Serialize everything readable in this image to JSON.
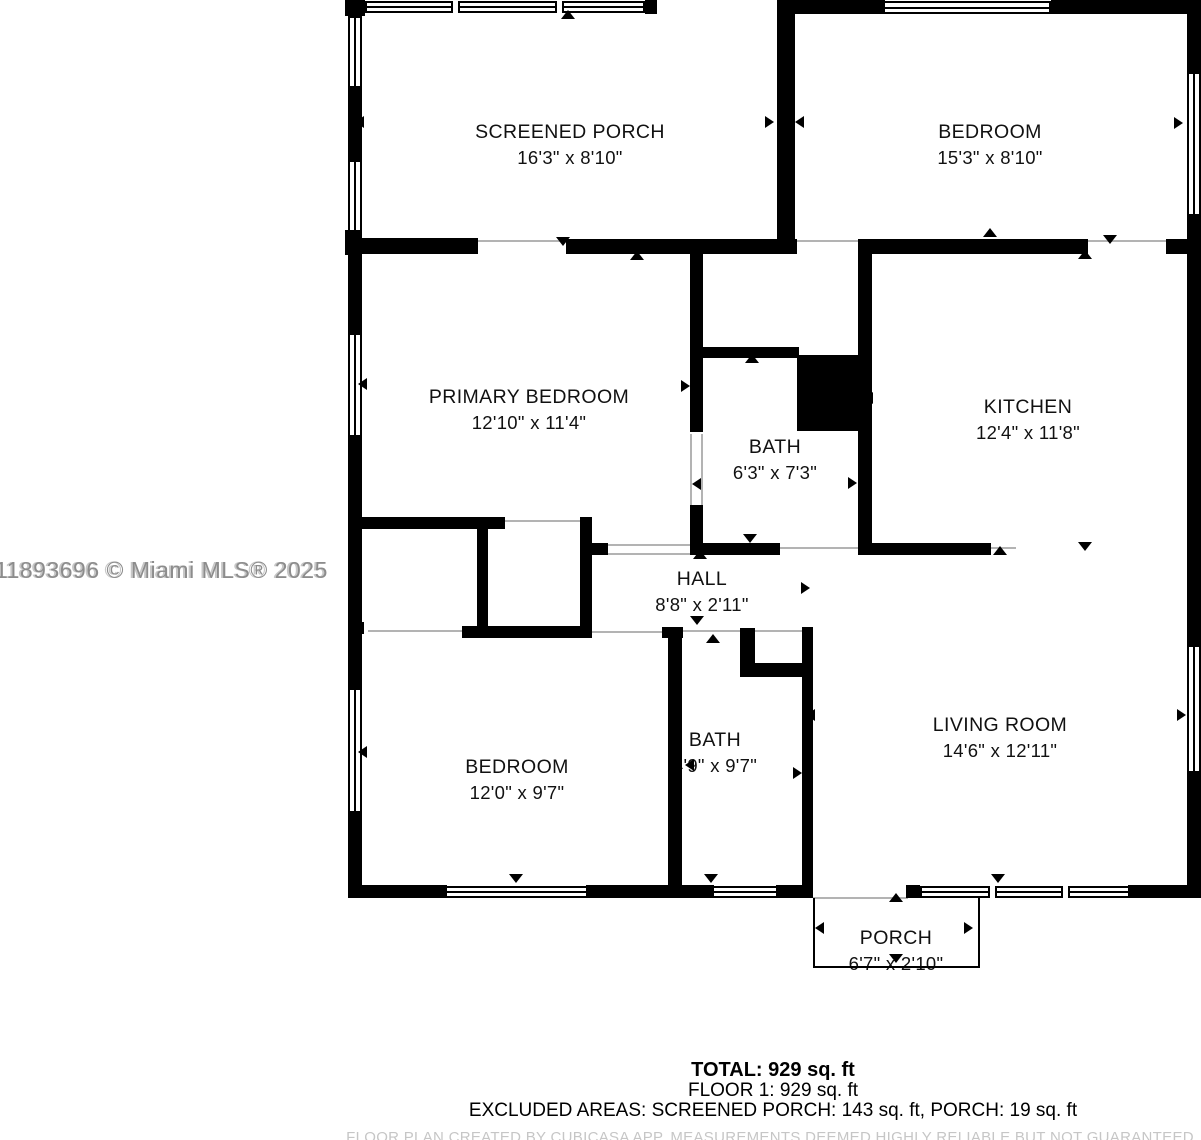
{
  "watermark": {
    "text": "11893696 © Miami MLS® 2025"
  },
  "summary": {
    "total": "TOTAL: 929 sq. ft",
    "floor1": "FLOOR 1: 929 sq. ft",
    "excluded": "EXCLUDED AREAS: SCREENED PORCH: 143 sq. ft, PORCH: 19 sq. ft",
    "disclaimer": "FLOOR PLAN CREATED BY CUBICASA APP. MEASUREMENTS DEEMED HIGHLY RELIABLE BUT NOT GUARANTEED"
  },
  "colors": {
    "wall": "#000000",
    "background": "#ffffff",
    "label": "#111111",
    "watermark": "#8c8c8c",
    "threshold": "#b3b3b3",
    "disclaimer": "#c6c6c6"
  },
  "rooms": [
    {
      "name": "SCREENED PORCH",
      "dims": "16'3\" x 8'10\"",
      "cx": 570,
      "cy": 132
    },
    {
      "name": "BEDROOM",
      "dims": "15'3\" x 8'10\"",
      "cx": 990,
      "cy": 132
    },
    {
      "name": "PRIMARY BEDROOM",
      "dims": "12'10\" x 11'4\"",
      "cx": 529,
      "cy": 397
    },
    {
      "name": "BATH",
      "dims": "6'3\" x 7'3\"",
      "cx": 775,
      "cy": 447
    },
    {
      "name": "KITCHEN",
      "dims": "12'4\" x 11'8\"",
      "cx": 1028,
      "cy": 407
    },
    {
      "name": "HALL",
      "dims": "8'8\" x 2'11\"",
      "cx": 702,
      "cy": 579
    },
    {
      "name": "BEDROOM",
      "dims": "12'0\" x 9'7\"",
      "cx": 517,
      "cy": 767
    },
    {
      "name": "BATH",
      "dims": "4'9\" x 9'7\"",
      "cx": 715,
      "cy": 740
    },
    {
      "name": "LIVING ROOM",
      "dims": "14'6\" x 12'11\"",
      "cx": 1000,
      "cy": 725
    },
    {
      "name": "PORCH",
      "dims": "6'7\" x 2'10\"",
      "cx": 896,
      "cy": 938
    }
  ],
  "geometry": {
    "walls": [
      {
        "x": 345,
        "y": 0,
        "w": 20,
        "h": 16
      },
      {
        "x": 348,
        "y": 88,
        "w": 14,
        "h": 74
      },
      {
        "x": 345,
        "y": 230,
        "w": 17,
        "h": 25
      },
      {
        "x": 348,
        "y": 255,
        "w": 14,
        "h": 80
      },
      {
        "x": 348,
        "y": 437,
        "w": 14,
        "h": 253
      },
      {
        "x": 348,
        "y": 811,
        "w": 14,
        "h": 87
      },
      {
        "x": 645,
        "y": 0,
        "w": 12,
        "h": 14
      },
      {
        "x": 777,
        "y": 0,
        "w": 18,
        "h": 253
      },
      {
        "x": 795,
        "y": 0,
        "w": 90,
        "h": 14
      },
      {
        "x": 1051,
        "y": 0,
        "w": 150,
        "h": 14
      },
      {
        "x": 1187,
        "y": 0,
        "w": 14,
        "h": 74
      },
      {
        "x": 1187,
        "y": 214,
        "w": 14,
        "h": 434
      },
      {
        "x": 1187,
        "y": 771,
        "w": 14,
        "h": 127
      },
      {
        "x": 362,
        "y": 238,
        "w": 116,
        "h": 16
      },
      {
        "x": 566,
        "y": 239,
        "w": 231,
        "h": 15
      },
      {
        "x": 858,
        "y": 239,
        "w": 230,
        "h": 15
      },
      {
        "x": 1166,
        "y": 239,
        "w": 35,
        "h": 15
      },
      {
        "x": 690,
        "y": 254,
        "w": 13,
        "h": 178
      },
      {
        "x": 690,
        "y": 505,
        "w": 13,
        "h": 50
      },
      {
        "x": 858,
        "y": 254,
        "w": 14,
        "h": 301
      },
      {
        "x": 695,
        "y": 347,
        "w": 104,
        "h": 11
      },
      {
        "x": 797,
        "y": 355,
        "w": 66,
        "h": 76
      },
      {
        "x": 695,
        "y": 543,
        "w": 85,
        "h": 12
      },
      {
        "x": 872,
        "y": 543,
        "w": 119,
        "h": 12
      },
      {
        "x": 362,
        "y": 517,
        "w": 143,
        "h": 12
      },
      {
        "x": 477,
        "y": 517,
        "w": 11,
        "h": 116
      },
      {
        "x": 580,
        "y": 517,
        "w": 12,
        "h": 121
      },
      {
        "x": 592,
        "y": 543,
        "w": 16,
        "h": 12
      },
      {
        "x": 462,
        "y": 626,
        "w": 130,
        "h": 12
      },
      {
        "x": 355,
        "y": 622,
        "w": 9,
        "h": 12
      },
      {
        "x": 662,
        "y": 627,
        "w": 21,
        "h": 11
      },
      {
        "x": 668,
        "y": 638,
        "w": 14,
        "h": 247
      },
      {
        "x": 740,
        "y": 628,
        "w": 15,
        "h": 49
      },
      {
        "x": 755,
        "y": 663,
        "w": 58,
        "h": 14
      },
      {
        "x": 802,
        "y": 627,
        "w": 11,
        "h": 258
      },
      {
        "x": 348,
        "y": 885,
        "w": 99,
        "h": 13
      },
      {
        "x": 586,
        "y": 885,
        "w": 128,
        "h": 13
      },
      {
        "x": 776,
        "y": 885,
        "w": 37,
        "h": 13
      },
      {
        "x": 906,
        "y": 885,
        "w": 14,
        "h": 13
      },
      {
        "x": 1128,
        "y": 885,
        "w": 73,
        "h": 13
      }
    ],
    "windows": [
      {
        "x": 365,
        "y": 1,
        "w": 280,
        "h": 12,
        "o": "h",
        "mullions": [
          88,
          192
        ]
      },
      {
        "x": 883,
        "y": 1,
        "w": 168,
        "h": 13,
        "o": "h"
      },
      {
        "x": 348,
        "y": 16,
        "w": 14,
        "h": 72,
        "o": "v"
      },
      {
        "x": 348,
        "y": 160,
        "w": 14,
        "h": 72,
        "o": "v"
      },
      {
        "x": 348,
        "y": 333,
        "w": 14,
        "h": 104,
        "o": "v"
      },
      {
        "x": 348,
        "y": 688,
        "w": 14,
        "h": 125,
        "o": "v"
      },
      {
        "x": 1187,
        "y": 72,
        "w": 14,
        "h": 144,
        "o": "v"
      },
      {
        "x": 1187,
        "y": 645,
        "w": 14,
        "h": 128,
        "o": "v"
      },
      {
        "x": 445,
        "y": 886,
        "w": 143,
        "h": 12,
        "o": "h"
      },
      {
        "x": 712,
        "y": 886,
        "w": 66,
        "h": 12,
        "o": "h"
      },
      {
        "x": 920,
        "y": 886,
        "w": 210,
        "h": 12,
        "o": "h",
        "mullions": [
          70,
          143
        ]
      }
    ],
    "thresholds": [
      {
        "x": 477,
        "y": 240,
        "w": 90,
        "h": 2
      },
      {
        "x": 795,
        "y": 240,
        "w": 65,
        "h": 2
      },
      {
        "x": 1088,
        "y": 240,
        "w": 80,
        "h": 2
      },
      {
        "x": 690,
        "y": 434,
        "w": 2,
        "h": 72
      },
      {
        "x": 701,
        "y": 434,
        "w": 2,
        "h": 72
      },
      {
        "x": 505,
        "y": 520,
        "w": 77,
        "h": 2
      },
      {
        "x": 608,
        "y": 544,
        "w": 84,
        "h": 2
      },
      {
        "x": 608,
        "y": 553,
        "w": 84,
        "h": 2
      },
      {
        "x": 780,
        "y": 547,
        "w": 80,
        "h": 2
      },
      {
        "x": 991,
        "y": 547,
        "w": 25,
        "h": 2
      },
      {
        "x": 368,
        "y": 630,
        "w": 94,
        "h": 2
      },
      {
        "x": 592,
        "y": 631,
        "w": 70,
        "h": 2
      },
      {
        "x": 683,
        "y": 630,
        "w": 57,
        "h": 2
      },
      {
        "x": 755,
        "y": 630,
        "w": 47,
        "h": 2
      },
      {
        "x": 813,
        "y": 897,
        "w": 95,
        "h": 2
      }
    ],
    "outlines": [
      {
        "x": 813,
        "y": 898,
        "w": 2,
        "h": 70
      },
      {
        "x": 978,
        "y": 898,
        "w": 2,
        "h": 70
      },
      {
        "x": 813,
        "y": 966,
        "w": 167,
        "h": 2
      }
    ],
    "arrows": [
      {
        "x": 568,
        "y": 16,
        "d": "up"
      },
      {
        "x": 362,
        "y": 122,
        "d": "left"
      },
      {
        "x": 772,
        "y": 122,
        "d": "right"
      },
      {
        "x": 802,
        "y": 122,
        "d": "left"
      },
      {
        "x": 1181,
        "y": 123,
        "d": "right"
      },
      {
        "x": 563,
        "y": 243,
        "d": "down"
      },
      {
        "x": 637,
        "y": 257,
        "d": "up"
      },
      {
        "x": 990,
        "y": 234,
        "d": "up"
      },
      {
        "x": 1110,
        "y": 241,
        "d": "down"
      },
      {
        "x": 1085,
        "y": 256,
        "d": "up"
      },
      {
        "x": 688,
        "y": 386,
        "d": "right"
      },
      {
        "x": 752,
        "y": 360,
        "d": "up"
      },
      {
        "x": 699,
        "y": 484,
        "d": "left"
      },
      {
        "x": 871,
        "y": 398,
        "d": "left"
      },
      {
        "x": 855,
        "y": 483,
        "d": "right"
      },
      {
        "x": 750,
        "y": 540,
        "d": "down"
      },
      {
        "x": 700,
        "y": 556,
        "d": "up"
      },
      {
        "x": 808,
        "y": 588,
        "d": "right"
      },
      {
        "x": 1000,
        "y": 552,
        "d": "up"
      },
      {
        "x": 1085,
        "y": 548,
        "d": "down"
      },
      {
        "x": 516,
        "y": 632,
        "d": "up"
      },
      {
        "x": 697,
        "y": 622,
        "d": "down"
      },
      {
        "x": 713,
        "y": 640,
        "d": "up"
      },
      {
        "x": 365,
        "y": 384,
        "d": "left"
      },
      {
        "x": 365,
        "y": 752,
        "d": "left"
      },
      {
        "x": 1184,
        "y": 715,
        "d": "right"
      },
      {
        "x": 813,
        "y": 715,
        "d": "left"
      },
      {
        "x": 800,
        "y": 773,
        "d": "right"
      },
      {
        "x": 692,
        "y": 765,
        "d": "left"
      },
      {
        "x": 516,
        "y": 880,
        "d": "down"
      },
      {
        "x": 711,
        "y": 880,
        "d": "down"
      },
      {
        "x": 998,
        "y": 880,
        "d": "down"
      },
      {
        "x": 896,
        "y": 899,
        "d": "up"
      },
      {
        "x": 822,
        "y": 928,
        "d": "left"
      },
      {
        "x": 971,
        "y": 928,
        "d": "right"
      },
      {
        "x": 896,
        "y": 960,
        "d": "down"
      }
    ]
  }
}
